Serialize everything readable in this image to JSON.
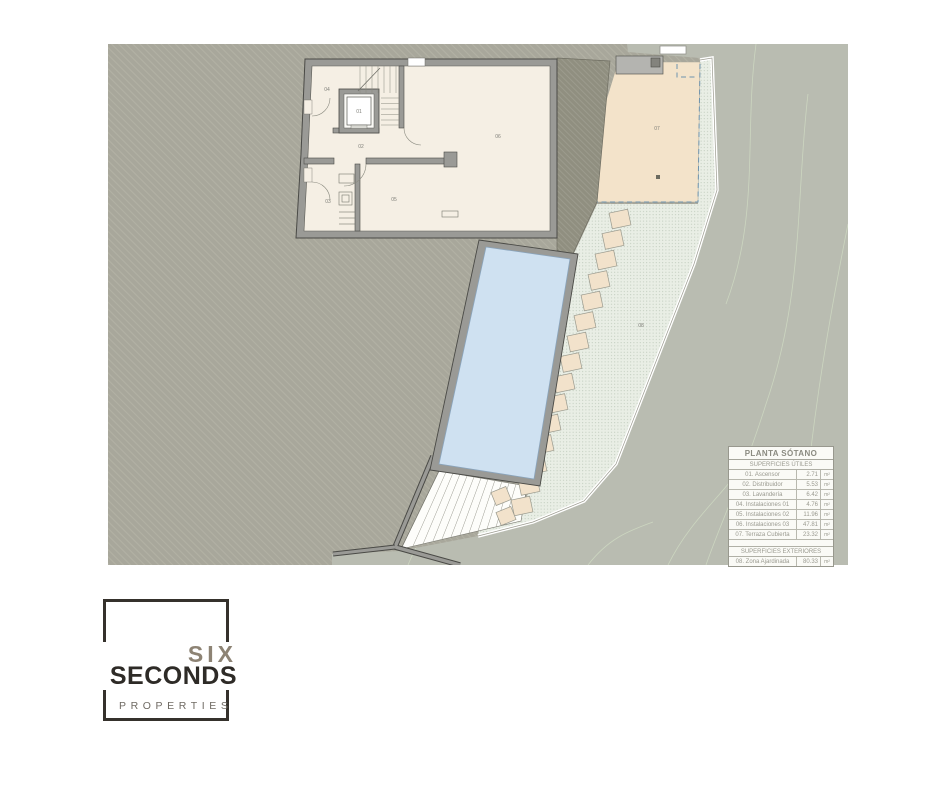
{
  "plan": {
    "title_note": "PLANTA SÓTANO",
    "room_labels": {
      "r01": "01",
      "r02": "02",
      "r03": "03",
      "r04": "04",
      "r05": "05",
      "r06": "06",
      "r07": "07",
      "r08": "08"
    },
    "legend": {
      "title": "PLANTA SÓTANO",
      "sections": [
        {
          "header": "SUPERFICIES ÚTILES",
          "rows": [
            {
              "label": "01. Ascensor",
              "value": "2.71",
              "unit": "m²"
            },
            {
              "label": "02. Distribuidor",
              "value": "5.53",
              "unit": "m²"
            },
            {
              "label": "03. Lavandería",
              "value": "6.42",
              "unit": "m²"
            },
            {
              "label": "04. Instalaciones 01",
              "value": "4.76",
              "unit": "m²"
            },
            {
              "label": "05. Instalaciones 02",
              "value": "11.96",
              "unit": "m²"
            },
            {
              "label": "06. Instalaciones 03",
              "value": "47.81",
              "unit": "m²"
            },
            {
              "label": "07. Terraza Cubierta",
              "value": "23.32",
              "unit": "m²"
            }
          ]
        },
        {
          "header": "SUPERFICIES EXTERIORES",
          "rows": [
            {
              "label": "08. Zona Ajardinada",
              "value": "80.33",
              "unit": "m²"
            }
          ]
        }
      ]
    },
    "colors": {
      "terrain_hatched": "#a8a79b",
      "terrain_smooth": "#b9bcb1",
      "interior_floor": "#f5efe4",
      "wall": "#9a9a96",
      "pool_water": "#cfe1f1",
      "terrace": "#f3e3ca",
      "garden": "#e9eee5",
      "stepping_stone": "#f2e2cb",
      "dashed_boundary": "#6e93ad",
      "contour_line": "#ccd6c0"
    }
  },
  "logo": {
    "word1": "SIX",
    "word2": "SECONDS",
    "word3": "PROPERTIES"
  }
}
